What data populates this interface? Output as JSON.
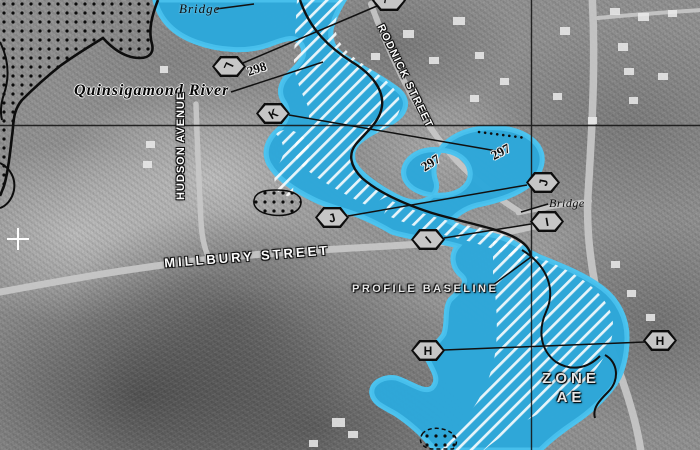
{
  "map": {
    "labels": {
      "bridge_top": "Bridge",
      "bridge_right": "Bridge",
      "river": "Quinsigamond River",
      "street_hudson": "HUDSON AVENUE",
      "street_rodnick": "RODNICK STREET",
      "street_millbury": "MILLBURY STREET",
      "profile_baseline": "PROFILE BASELINE",
      "zone_word": "ZONE",
      "zone_class": "AE",
      "bfe_298": "298",
      "bfe_297_left": "297",
      "bfe_297_right": "297"
    },
    "hexagons": [
      {
        "id": "l-top",
        "letter": "L"
      },
      {
        "id": "l",
        "letter": "L"
      },
      {
        "id": "k",
        "letter": "K"
      },
      {
        "id": "j-left",
        "letter": "J"
      },
      {
        "id": "i-mid",
        "letter": "I"
      },
      {
        "id": "j-right",
        "letter": "J"
      },
      {
        "id": "i-right",
        "letter": "I"
      },
      {
        "id": "h-left",
        "letter": "H"
      },
      {
        "id": "h-right",
        "letter": "H"
      }
    ],
    "colors": {
      "flood_zone_blue": "#2EA7DA",
      "flood_edge_cyan": "#4CC3EF",
      "floodway_hatch": "#FFFFFF",
      "map_line_black": "#111111"
    }
  }
}
